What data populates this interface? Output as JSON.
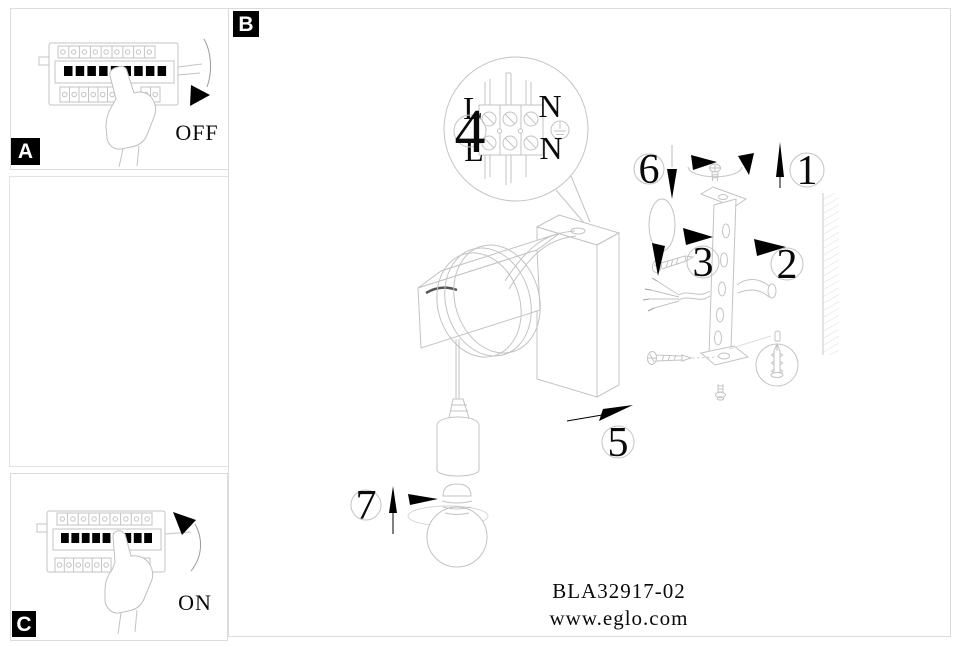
{
  "colors": {
    "background": "#ffffff",
    "line_art": "#c3c3c3",
    "panel_border": "#dcdcdc",
    "ink": "#000000",
    "label_bg": "#000000",
    "label_fg": "#ffffff"
  },
  "panels": {
    "a": {
      "label": "A",
      "switch_state": "OFF"
    },
    "b": {
      "label": "B"
    },
    "c": {
      "label": "C",
      "switch_state": "ON"
    }
  },
  "wiring_detail": {
    "callout_number": "4",
    "terminals": {
      "top_left": "L",
      "top_right": "N",
      "bottom_left": "L",
      "bottom_right": "N"
    }
  },
  "callouts": {
    "c1": "1",
    "c2": "2",
    "c3": "3",
    "c5": "5",
    "c6": "6",
    "c7": "7"
  },
  "footer": {
    "model_number": "BLA32917-02",
    "website": "www.eglo.com"
  }
}
